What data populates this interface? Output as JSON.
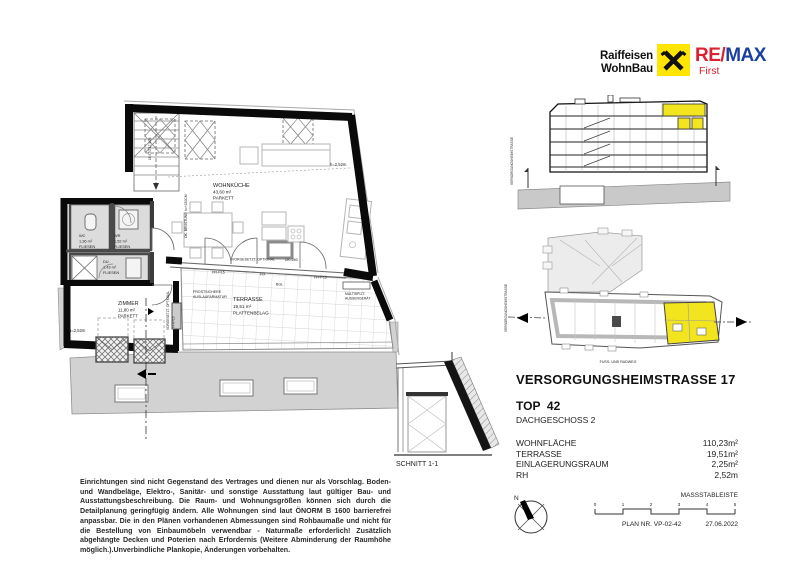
{
  "branding": {
    "raiffeisen_line1": "Raiffeisen",
    "raiffeisen_line2": "WohnBau",
    "remax_re": "RE",
    "remax_slash": "/",
    "remax_max": "MAX",
    "remax_sub": "First",
    "colors": {
      "raiffeisen_yellow": "#FFE500",
      "remax_red": "#D92231",
      "remax_blue": "#1B3FA0",
      "highlight_yellow": "#F2E41E"
    }
  },
  "floorplan": {
    "rooms": [
      {
        "name": "WOHNKÜCHE",
        "area": "43,60 m²",
        "floor": "PARKETT"
      },
      {
        "name": "ZIMMER",
        "area": "11,80 m²",
        "floor": "PARKETT"
      },
      {
        "name": "TERRASSE",
        "area": "19,51 m²",
        "floor": "PLATTENBELAG"
      },
      {
        "name": "WC",
        "area": "1,36 m²",
        "floor": "FLIESEN"
      },
      {
        "name": "WR",
        "area": "1,52 m²",
        "floor": "FLIESEN"
      },
      {
        "name": "DU.",
        "area": "1,43 m²",
        "floor": "FLIESEN"
      }
    ],
    "annotations": {
      "height_living": "h=2,52m",
      "height_zimmer": "h=2,52m",
      "frost_1": "FROSTSICHERE",
      "frost_2": "AUSLAUFARMATUR",
      "multisplit_1": "MULTISPLIT-",
      "multisplit_2": "AUSSENGERÄT",
      "vorgesetzt": "VORGESETZT. OPTIONAL",
      "fix": "FIX",
      "ffh_left": "FFH=15",
      "ffh_right": "FFH=15",
      "ffh_zimmer": "FFH=15",
      "bgl": "BGL",
      "uk": "UK=260",
      "bruestung": "OK. BRÜSTUNG h=+150CM",
      "stairs": "18 STG 17,4/24"
    }
  },
  "section_drawing": {
    "street_label": "VERSORGUNGSHEIMSTRASSE"
  },
  "site_plan": {
    "street_label": "VERSORGUNGSHEIMSTRASSE",
    "path_label": "FUSS- UND RADWEG"
  },
  "schnitt": {
    "label": "SCHNITT 1-1"
  },
  "address": {
    "street": "VERSORGUNGSHEIMSTRASSE 17",
    "unit": "TOP  42",
    "floor": "DACHGESCHOSS 2",
    "rows": [
      {
        "label": "WOHNFLÄCHE",
        "value": "110,23m²"
      },
      {
        "label": "TERRASSE",
        "value": "19,51m²"
      },
      {
        "label": "EINLAGERUNGSRAUM",
        "value": "2,25m²"
      },
      {
        "label": "RH",
        "value": "2,52m"
      }
    ]
  },
  "disclaimer": "Einrichtungen sind nicht Gegenstand des Vertrages und dienen nur als Vorschlag. Boden- und Wandbeläge, Elektro-, Sanitär- und sonstige Ausstattung laut gültiger Bau- und Ausstattungsbeschreibung. Die Raum- und Wohnungsgrößen können sich durch die Detailplanung geringfügig ändern. Alle Wohnungen sind laut ÖNORM B 1600 barrierefrei anpassbar. Die in den Plänen vorhandenen Abmessungen sind Rohbaumaße und nicht für die Bestellung von Einbaumöbeln verwendbar - Naturmaße erforderlich! Zusätzlich abgehängte Decken und Poterien nach Erfordernis (Weitere Abminderung der Raumhöhe möglich.).Unverbindliche Plankopie, Änderungen vorbehalten.",
  "footer": {
    "scale_label": "MASSSTABLEISTE",
    "scale_ticks": [
      "0",
      "1",
      "2",
      "3",
      "4",
      "5"
    ],
    "plan_no": "PLAN NR. VP-02-42",
    "date": "27.06.2022",
    "compass_north": "N"
  }
}
